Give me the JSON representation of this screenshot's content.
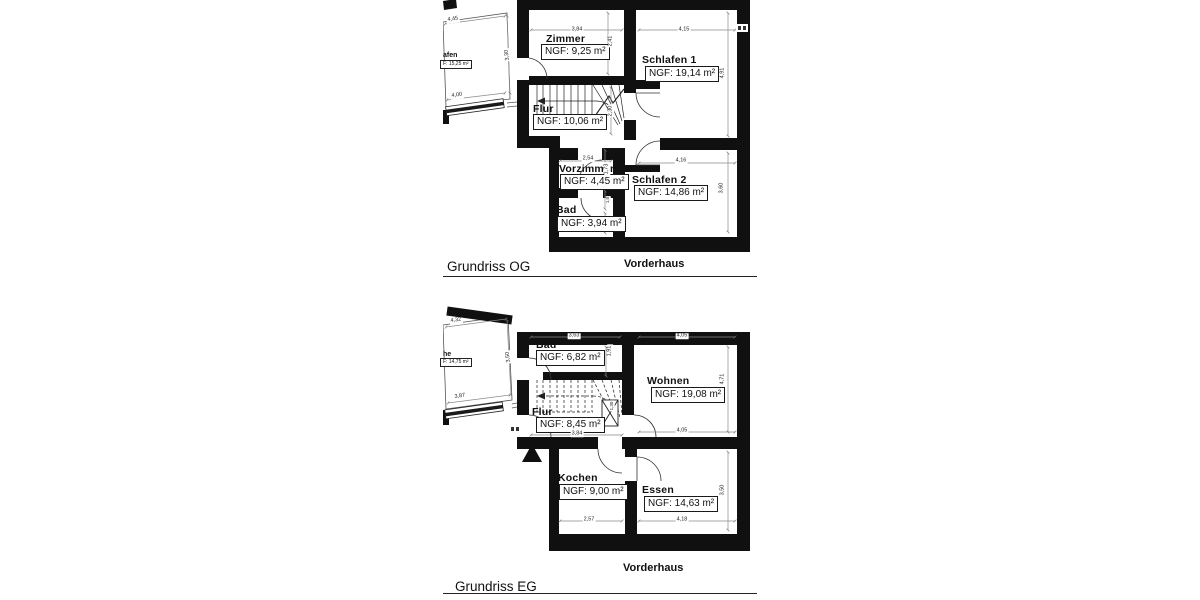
{
  "colors": {
    "wall": "#101010",
    "dim_line": "#8a8a8a",
    "thin_line": "#555555"
  },
  "og": {
    "title": "Grundriss OG",
    "building": "Vorderhaus",
    "rooms": {
      "neighbor": {
        "name": "afen",
        "area": "F: 15,25 m²"
      },
      "zimmer": {
        "name": "Zimmer",
        "area": "NGF: 9,25 m²"
      },
      "schlafen1": {
        "name": "Schlafen 1",
        "area": "NGF: 19,14 m²"
      },
      "flur": {
        "name": "Flur",
        "area": "NGF: 10,06 m²"
      },
      "vorzimmer": {
        "name": "Vorzimmer",
        "area": "NGF: 4,45 m²"
      },
      "bad": {
        "name": "Bad",
        "area": "NGF: 3,94 m²"
      },
      "schlafen2": {
        "name": "Schlafen 2",
        "area": "NGF: 14,86 m²"
      }
    },
    "dims": {
      "wing_top": "4,45",
      "wing_right": "3,30",
      "wing_bottom": "4,00",
      "zimmer_top": "3,84",
      "zimmer_right": "2,41",
      "schlafen1_top": "4,15",
      "schlafen1_right": "4,91",
      "flur_right": "2,30",
      "vorzimmer_top": "2,54",
      "vorzimmer_right": "1,73",
      "bad_right_upper": "1,0",
      "bad_right_lower": "0,95",
      "schlafen2_top": "4,16",
      "schlafen2_right": "3,60"
    }
  },
  "eg": {
    "title": "Grundriss EG",
    "building": "Vorderhaus",
    "rooms": {
      "neighbor": {
        "name": "he",
        "area": "F: 14,75 m²"
      },
      "bad": {
        "name": "Bad",
        "area": "NGF: 6,82 m²"
      },
      "wohnen": {
        "name": "Wohnen",
        "area": "NGF: 19,08 m²"
      },
      "flur": {
        "name": "Flur",
        "area": "NGF: 8,45 m²"
      },
      "kochen": {
        "name": "Kochen",
        "area": "NGF: 9,00 m²"
      },
      "essen": {
        "name": "Essen",
        "area": "NGF: 14,63 m²"
      }
    },
    "dims": {
      "wing_top": "4,32",
      "wing_right": "3,50",
      "wing_bottom": "3,87",
      "bad_top": "3,63",
      "bad_right": "1,91",
      "wohnen_top": "4,05",
      "wohnen_right": "4,71",
      "wohnen_bottom": "4,05",
      "flur_bottom": "3,84",
      "stair_shaft": "1,30",
      "kochen_bottom": "2,57",
      "essen_bottom": "4,18",
      "essen_right": "3,50"
    }
  }
}
